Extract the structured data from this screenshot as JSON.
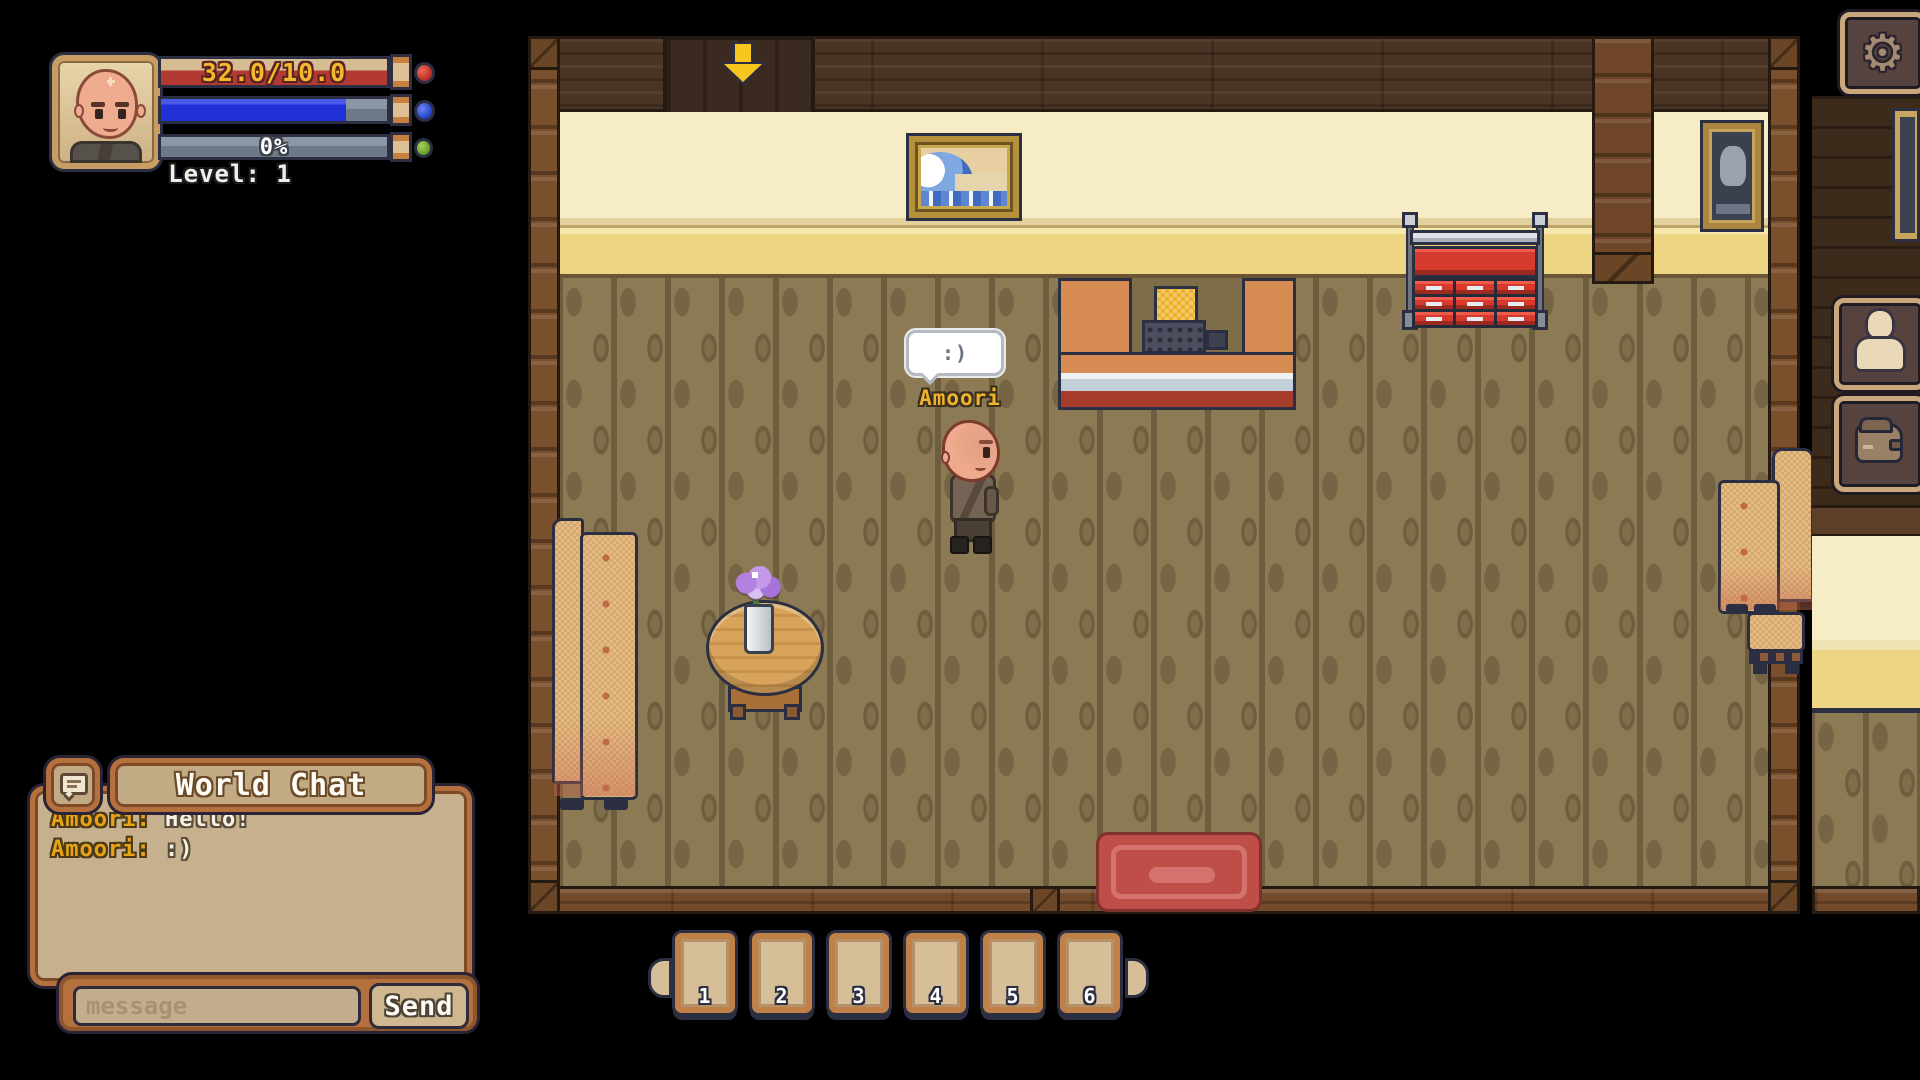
{
  "hud": {
    "level_label": "Level: 1",
    "health": {
      "text": "32.0/10.0",
      "fill_pct": 100,
      "fill_color": "#b23a33",
      "text_color": "#f4b82c"
    },
    "mana": {
      "fill_pct": 82,
      "fill_color": "#1f30d6"
    },
    "xp": {
      "text": "0%",
      "fill_pct": 0
    }
  },
  "player": {
    "name": "Amoori",
    "speech": ":)"
  },
  "chat": {
    "title": "World Chat",
    "messages": [
      {
        "name": "Amoori:",
        "text": "Hello!"
      },
      {
        "name": "Amoori:",
        "text": ":)"
      }
    ],
    "input_placeholder": "message",
    "send_label": "Send"
  },
  "hotbar": {
    "slots": [
      "1",
      "2",
      "3",
      "4",
      "5",
      "6"
    ]
  },
  "icons": {
    "settings": "gear-icon",
    "settings_glyph": "⚙",
    "character": "character-icon",
    "inventory": "bag-icon",
    "chat_toggle": "chat-bubble-icon",
    "quest_marker": "down-arrow-icon"
  },
  "colors": {
    "name_gold": "#f2b32a",
    "chat_name_gold": "#e8a416",
    "panel_tan": "#c6b08e",
    "panel_border": "#b4713d",
    "slot_tan": "#d6bf98",
    "outline_navy": "#2c2f42"
  }
}
